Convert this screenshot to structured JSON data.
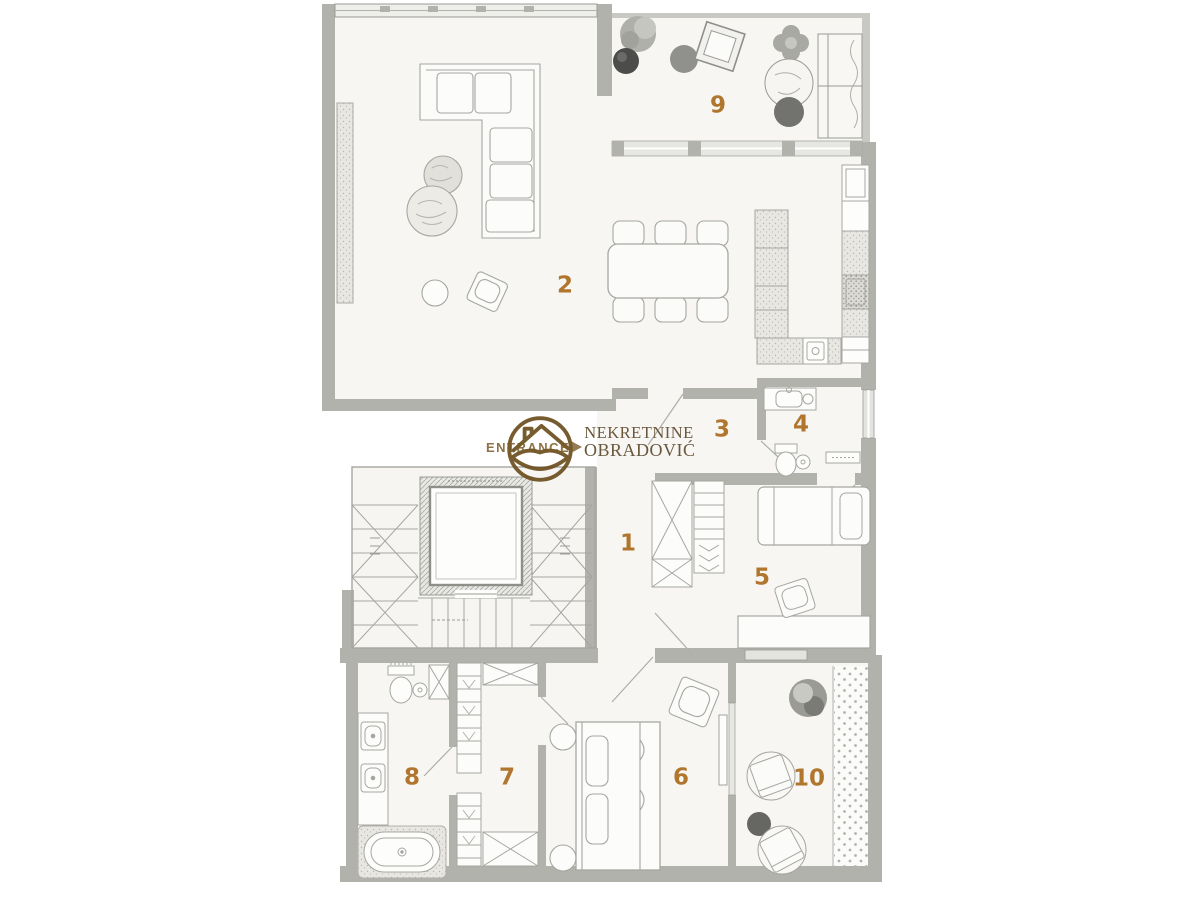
{
  "rooms": {
    "r1": "1",
    "r2": "2",
    "r3": "3",
    "r4": "4",
    "r5": "5",
    "r6": "6",
    "r7": "7",
    "r8": "8",
    "r9": "9",
    "r10": "10"
  },
  "watermark": {
    "entrance_label": "ENTRANCE",
    "agency_line1": "NEKRETNINE",
    "agency_line2": "OBRADOVIĆ"
  },
  "palette": {
    "wall": "#b2b2ac",
    "wall_light": "#e6e6e2",
    "floor": "#f7f6f3",
    "furniture_line": "#a6a6a1",
    "room_number": "#b1762e",
    "brand_brown": "#6b4f1e",
    "agency_text": "#6a573d",
    "dark_gray": "#70706c"
  }
}
